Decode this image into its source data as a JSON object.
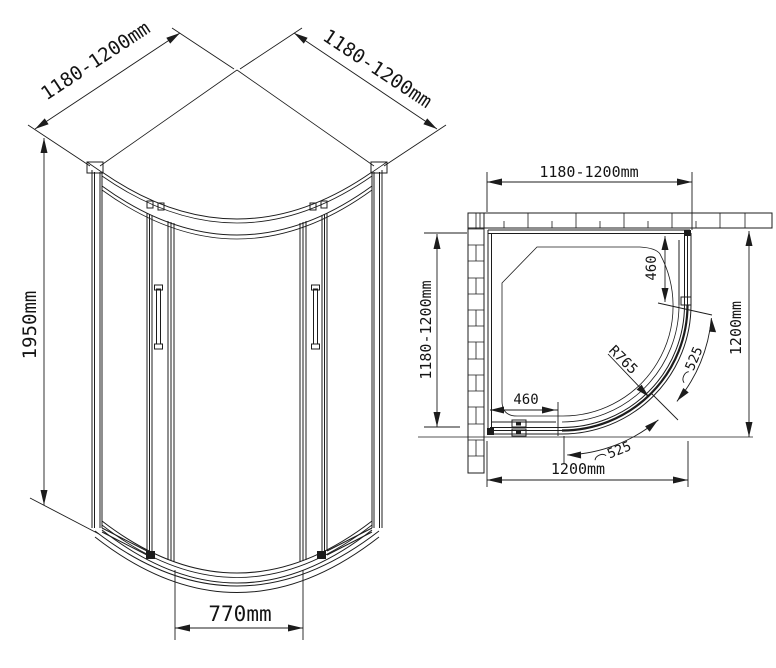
{
  "drawing": {
    "front_view": {
      "width_left": "1180-1200mm",
      "width_right": "1180-1200mm",
      "height": "1950mm",
      "opening": "770mm"
    },
    "plan_view": {
      "width_top": "1180-1200mm",
      "depth_left": "1180-1200mm",
      "width_bottom": "1200mm",
      "depth_right": "1200mm",
      "fixed_panel_right": "460",
      "fixed_panel_bottom": "460",
      "door_radius": "R765",
      "arc_door_right": "525",
      "arc_door_bottom": "525"
    },
    "line_color": "#1c1c1c",
    "background_color": "#ffffff"
  }
}
